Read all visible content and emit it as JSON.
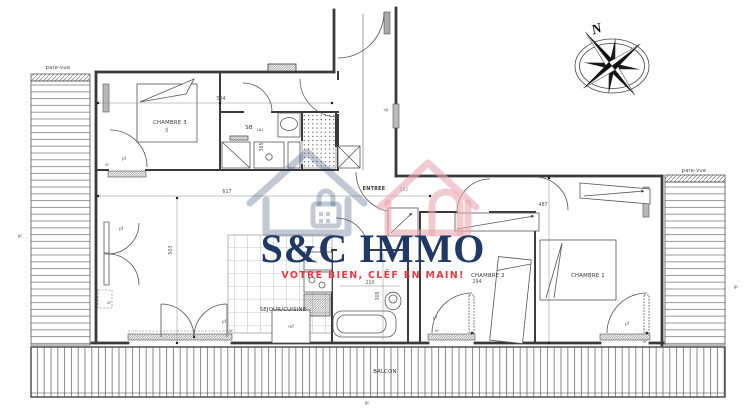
{
  "watermark": {
    "brand": "S&C IMMO",
    "tagline": "VOTRE BIEN, CLÉF EN MAIN!"
  },
  "compass": {
    "north": "N"
  },
  "rooms": {
    "chambre3": "CHAMBRE 3",
    "sb": "SB",
    "sb_num": "162",
    "sejour": "SEJOUR/CUISINE",
    "entree": "ENTREE",
    "chambre2": "CHAMBRE 2",
    "chambre1": "CHAMBRE 1",
    "balcon": "BALCON"
  },
  "screens": {
    "left": "pare-vue",
    "right": "pare-vue"
  },
  "dims": {
    "d584": "584",
    "d617": "617",
    "d503": "503",
    "d487": "487",
    "d294": "294",
    "d210": "210",
    "d305": "305",
    "d365": "365",
    "d142": "142",
    "d26": "26"
  },
  "tags": {
    "pf": "pf",
    "vr": "vr",
    "vp": "vp",
    "gc": "gc",
    "ref": "ref",
    "cu": "cu"
  },
  "colors": {
    "brand_navy": "#1f3864",
    "brand_red": "#e23b43",
    "line": "#3a3a3a"
  }
}
